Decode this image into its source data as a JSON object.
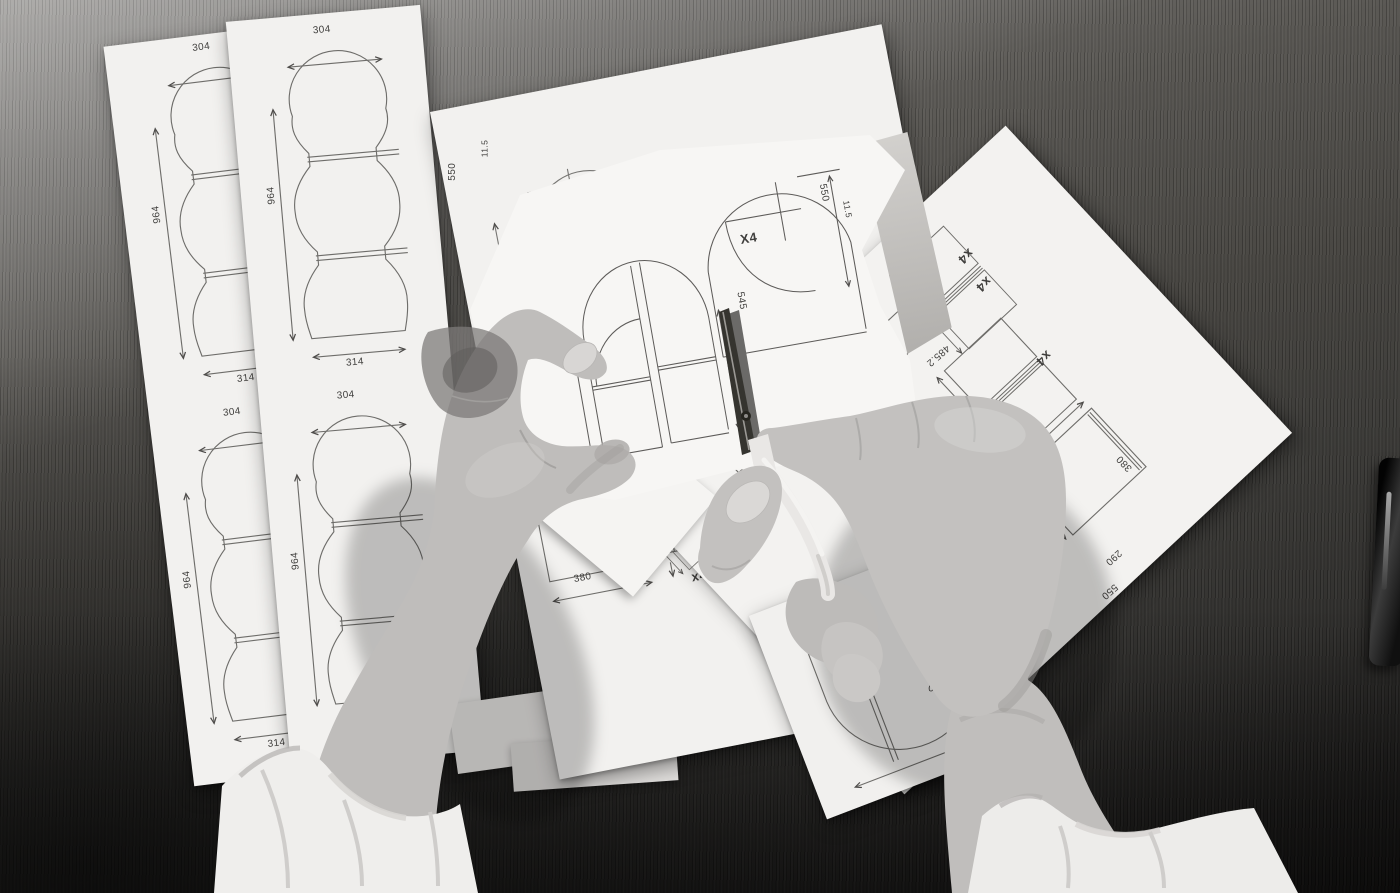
{
  "colors": {
    "paper": "#f2f1ef",
    "line_gray": "#6e6d6a",
    "label_gray": "#3f3e3c",
    "wood_dark": "#3b3a37",
    "skin_gray": "#c3c1bf",
    "sleeve_white": "#efeeec",
    "scissors_handle": "#e9e7e5",
    "blade_dark": "#3a3a38"
  },
  "labels": {
    "sheet_a": {
      "top_width_1": "304",
      "height_1": "964",
      "bottom_width_1": "314",
      "top_width_2": "304",
      "height_2": "964",
      "bottom_width_2": "314"
    },
    "sheet_b": {
      "top_width_1": "304",
      "height_1": "964",
      "bottom_width_1": "314",
      "top_width_2": "304",
      "height_2": "964"
    },
    "sheet_c": {
      "height_dim": "550",
      "small_dim": "11.5",
      "width_dim": "380",
      "quantity": "x4"
    },
    "held_paper": {
      "side_dim": "545",
      "quantity": "X4",
      "height_dim": "550",
      "small_dim": "11.5"
    },
    "sheet_d": {
      "quantity_1": "x4",
      "quantity_2": "x4",
      "quantity_3": "x4",
      "quantity_4": "x4",
      "quantity_5": "x4",
      "length_dim": "485.2",
      "side_dim": "545",
      "height_dim": "380",
      "width_dim": "290",
      "depth_dim": "550"
    },
    "sheet_e": {
      "width_dim": "380",
      "small_dim": "11.5",
      "depth_dim": "550"
    }
  }
}
